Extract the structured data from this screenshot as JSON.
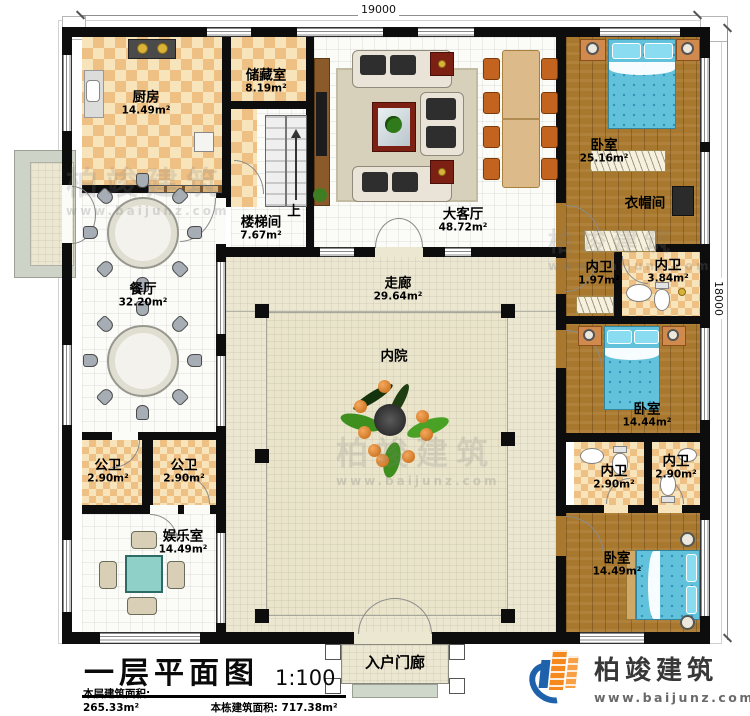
{
  "plan": {
    "dimensions": {
      "top": "19000",
      "right": "18000"
    },
    "stairs_up_label": "上",
    "rooms": [
      {
        "name": "厨房",
        "area": "14.49m²"
      },
      {
        "name": "储藏室",
        "area": "8.19m²"
      },
      {
        "name": "楼梯间",
        "area": "7.67m²"
      },
      {
        "name": "大客厅",
        "area": "48.72m²"
      },
      {
        "name": "卧室",
        "area": "25.16m²"
      },
      {
        "name": "衣帽间",
        "area": ""
      },
      {
        "name": "餐厅",
        "area": "32.20m²"
      },
      {
        "name": "走廊",
        "area": "29.64m²"
      },
      {
        "name": "内院",
        "area": ""
      },
      {
        "name": "内卫",
        "area": "1.97m²"
      },
      {
        "name": "内卫",
        "area": "3.84m²"
      },
      {
        "name": "卧室",
        "area": "14.44m²"
      },
      {
        "name": "公卫",
        "area": "2.90m²"
      },
      {
        "name": "公卫",
        "area": "2.90m²"
      },
      {
        "name": "娱乐室",
        "area": "14.49m²"
      },
      {
        "name": "内卫",
        "area": "2.90m²"
      },
      {
        "name": "内卫",
        "area": "2.90m²"
      },
      {
        "name": "卧室",
        "area": "14.49m²"
      },
      {
        "name": "入户门廊",
        "area": ""
      }
    ]
  },
  "title_block": {
    "title": "一层平面图",
    "scale": "1:100",
    "stats": [
      {
        "label": "本层建筑面积:",
        "value": "265.33m²"
      },
      {
        "label": "本栋建筑面积:",
        "value": "717.38m²"
      },
      {
        "label": "占地面积:",
        "value": "350.94m²"
      },
      {
        "label": "层高:",
        "value": "4.2m"
      }
    ]
  },
  "brand": {
    "name": "柏竣建筑",
    "url": "www.baijunz.com"
  },
  "watermark": {
    "text": "柏竣建筑",
    "url": "www.baijunz.com"
  },
  "colors": {
    "wall": "#0d0d0d",
    "wood_floor": "#a8782e",
    "checker_tan": "#eec084",
    "bed_blue": "#62c2dc",
    "logo_orange": "#f5891d",
    "logo_blue": "#1e62ac",
    "courtyard_beige": "#ece7d1"
  }
}
